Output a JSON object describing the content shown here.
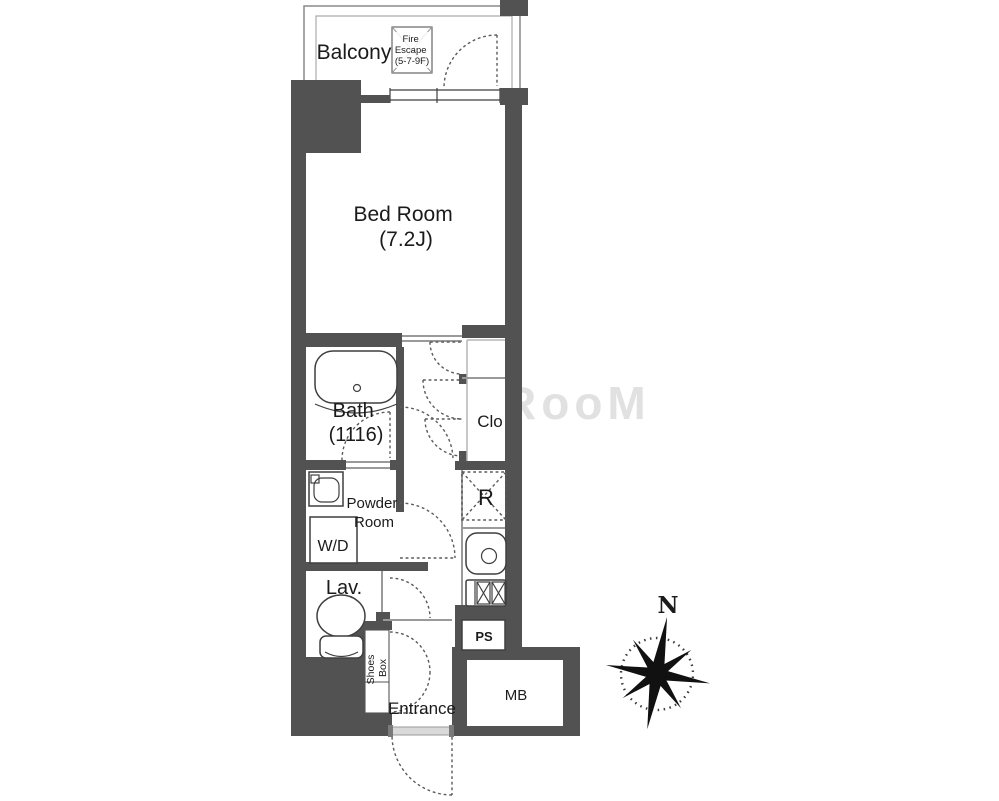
{
  "floorplan": {
    "balcony": {
      "label": "Balcony"
    },
    "fire_escape": {
      "lines": [
        "Fire",
        "Escape",
        "(5-7-9F)"
      ]
    },
    "bedroom": {
      "name": "Bed Room",
      "size": "(7.2J)"
    },
    "bath": {
      "name": "Bath",
      "size": "(1116)"
    },
    "closet": {
      "label": "Clo"
    },
    "powder_room": {
      "lines": [
        "Powder",
        "Room"
      ]
    },
    "washer_dryer": {
      "label": "W/D"
    },
    "lavatory": {
      "label": "Lav."
    },
    "refrigerator": {
      "label": "R"
    },
    "pipe_space": {
      "label": "PS"
    },
    "meter_box": {
      "label": "MB"
    },
    "shoes_box": {
      "lines": [
        "Shoes",
        "Box"
      ]
    },
    "entrance": {
      "label": "Entrance"
    },
    "compass": {
      "north_label": "N"
    },
    "watermark": {
      "text": "RooM"
    },
    "colors": {
      "wall": "#525252",
      "line": "#3f3f3f",
      "light_line": "#9a9a9a",
      "background": "#ffffff"
    }
  }
}
